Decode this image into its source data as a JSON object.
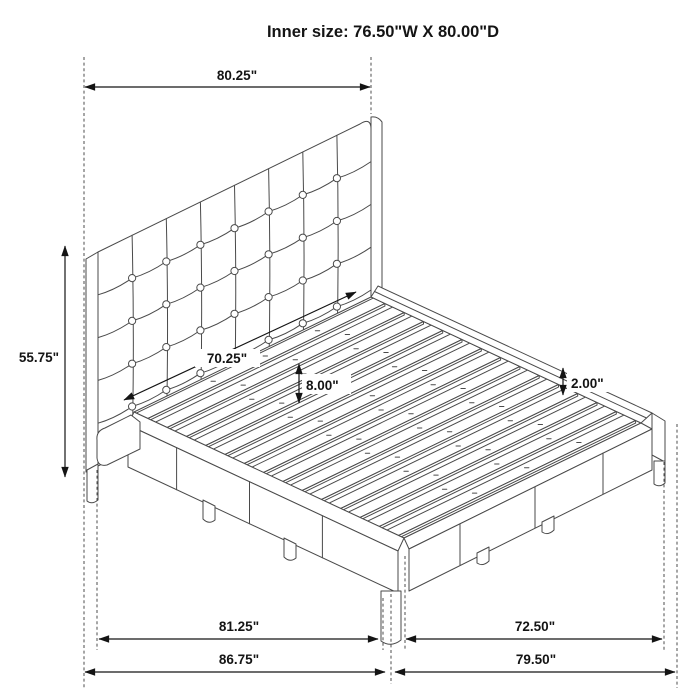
{
  "title": "Inner size: 76.50\"W X 80.00\"D",
  "dimensions": {
    "top_width": "80.25\"",
    "left_height": "55.75\"",
    "inner_span": "70.25\"",
    "slat_clearance": "8.00\"",
    "rail_above_slats": "2.00\"",
    "bottom_inner_left": "81.25\"",
    "bottom_inner_right": "72.50\"",
    "bottom_outer_left": "86.75\"",
    "bottom_outer_right": "79.50\""
  },
  "line_color": "#4a4a4a",
  "dimension_color": "#141414"
}
